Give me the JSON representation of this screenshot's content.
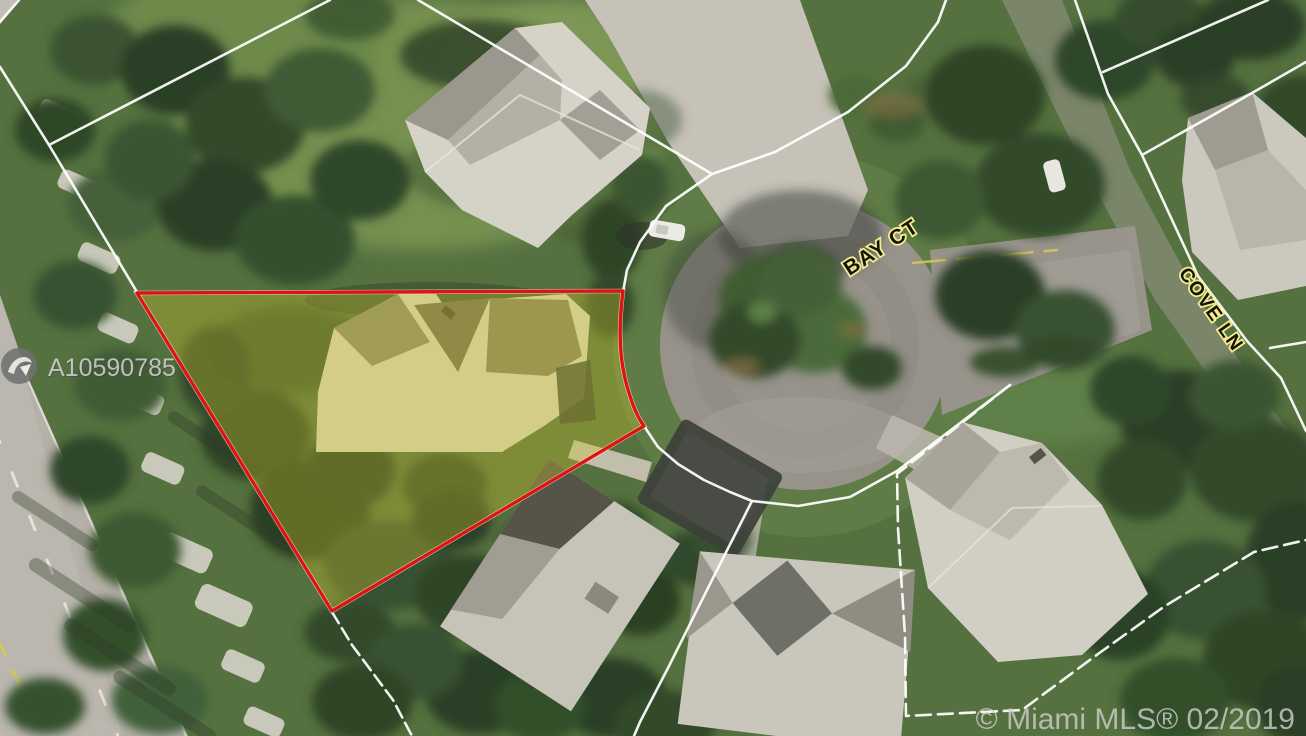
{
  "map": {
    "type": "aerial-satellite-listing-map",
    "street_labels": {
      "bay_ct": "BAY CT",
      "cove_ln": "COVE LN"
    },
    "mls_id": "A10590785",
    "watermark": "© Miami MLS® 02/2019",
    "colors": {
      "parcel_outline": "#dd1410",
      "parcel_fill": "rgba(205,192,45,0.34)",
      "boundary_line": "#ffffff",
      "street_label_fill": "#14140a",
      "street_label_outline": "#f3eb8d",
      "road_centerline_yellow": "#d9c84f",
      "mls_id_color": "#d9d9d9",
      "watermark_color": "#cfcfcf"
    },
    "icons": {
      "mls_logo": "circle-swoosh-logo"
    }
  }
}
